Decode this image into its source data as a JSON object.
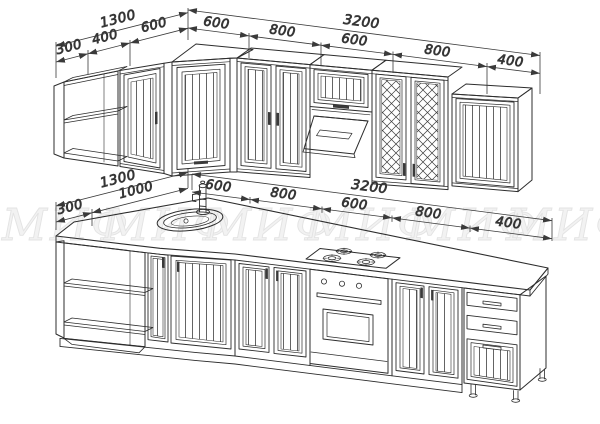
{
  "watermark": {
    "text": "МИФ",
    "color": "#f2f2f2"
  },
  "dimensions": {
    "upper": {
      "left_total": "1300",
      "left_segments": [
        "300",
        "400",
        "600"
      ],
      "right_total": "3200",
      "right_segments": [
        "600",
        "800",
        "600",
        "800",
        "400"
      ]
    },
    "lower": {
      "left_total": "1300",
      "left_segments": [
        "300",
        "1000"
      ],
      "right_total": "3200",
      "right_segments": [
        "600",
        "800",
        "600",
        "800",
        "400"
      ]
    }
  },
  "drawing": {
    "line_color": "#2d2d2d",
    "dim_color": "#3a3a3a",
    "upper_units": [
      "open-corner-shelf",
      "single-door-cabinet",
      "corner-cabinet",
      "double-door-cabinet",
      "hood-cabinet-with-extractor",
      "lattice-double-door-cabinet",
      "single-door-end-cabinet"
    ],
    "lower_units": [
      "open-corner-shelf",
      "corner-sink-cabinet-with-faucet",
      "double-door-cabinet",
      "oven-with-gas-hob",
      "double-door-cabinet",
      "three-drawer-unit"
    ]
  }
}
